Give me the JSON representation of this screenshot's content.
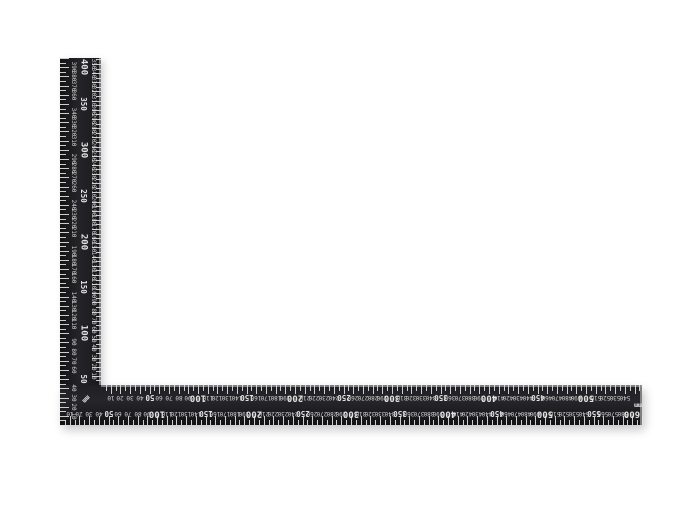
{
  "scene": {
    "background_color": "#ffffff",
    "subject": "L-shaped black steel framing square ruler, metric"
  },
  "square": {
    "body_color": "#1a1a1d",
    "bevel_color": "#909094",
    "mark_color": "#e2e2e2",
    "corner_unit_label": "mm",
    "horizontal_arm": {
      "length_mm": 600,
      "outer_scale": {
        "edge": "bottom",
        "unit": "mm",
        "min": 0,
        "max": 600,
        "small_number_step": 10,
        "medium_labels": [
          50,
          150,
          250,
          350,
          450,
          550
        ],
        "major_labels": [
          100,
          200,
          300,
          400,
          500,
          600
        ],
        "tick_step": 5,
        "numbers_rotation_deg": 180
      },
      "inner_scale": {
        "edge": "top",
        "unit": "mm",
        "min": 0,
        "max": 540,
        "small_number_step": 10,
        "medium_labels": [
          50,
          150,
          250,
          350,
          450
        ],
        "major_labels": [
          100,
          200,
          300,
          400,
          500
        ],
        "tick_step": 5,
        "numbers_rotation_deg": 180,
        "unit_label": "mm"
      }
    },
    "vertical_arm": {
      "length_mm": 400,
      "outer_scale": {
        "edge": "left",
        "unit": "mm",
        "min": 0,
        "max": 400,
        "small_number_step": 10,
        "medium_labels": [
          50,
          150,
          250,
          350
        ],
        "major_labels": [
          100,
          200,
          300,
          400
        ],
        "tick_step": 5,
        "numbers_rotation_deg": 90
      },
      "inner_scale": {
        "edge": "right",
        "unit": "mm",
        "min": 0,
        "max": 350,
        "small_number_step": 10,
        "tick_step": 5,
        "numbers_rotation_deg": 90
      }
    }
  }
}
